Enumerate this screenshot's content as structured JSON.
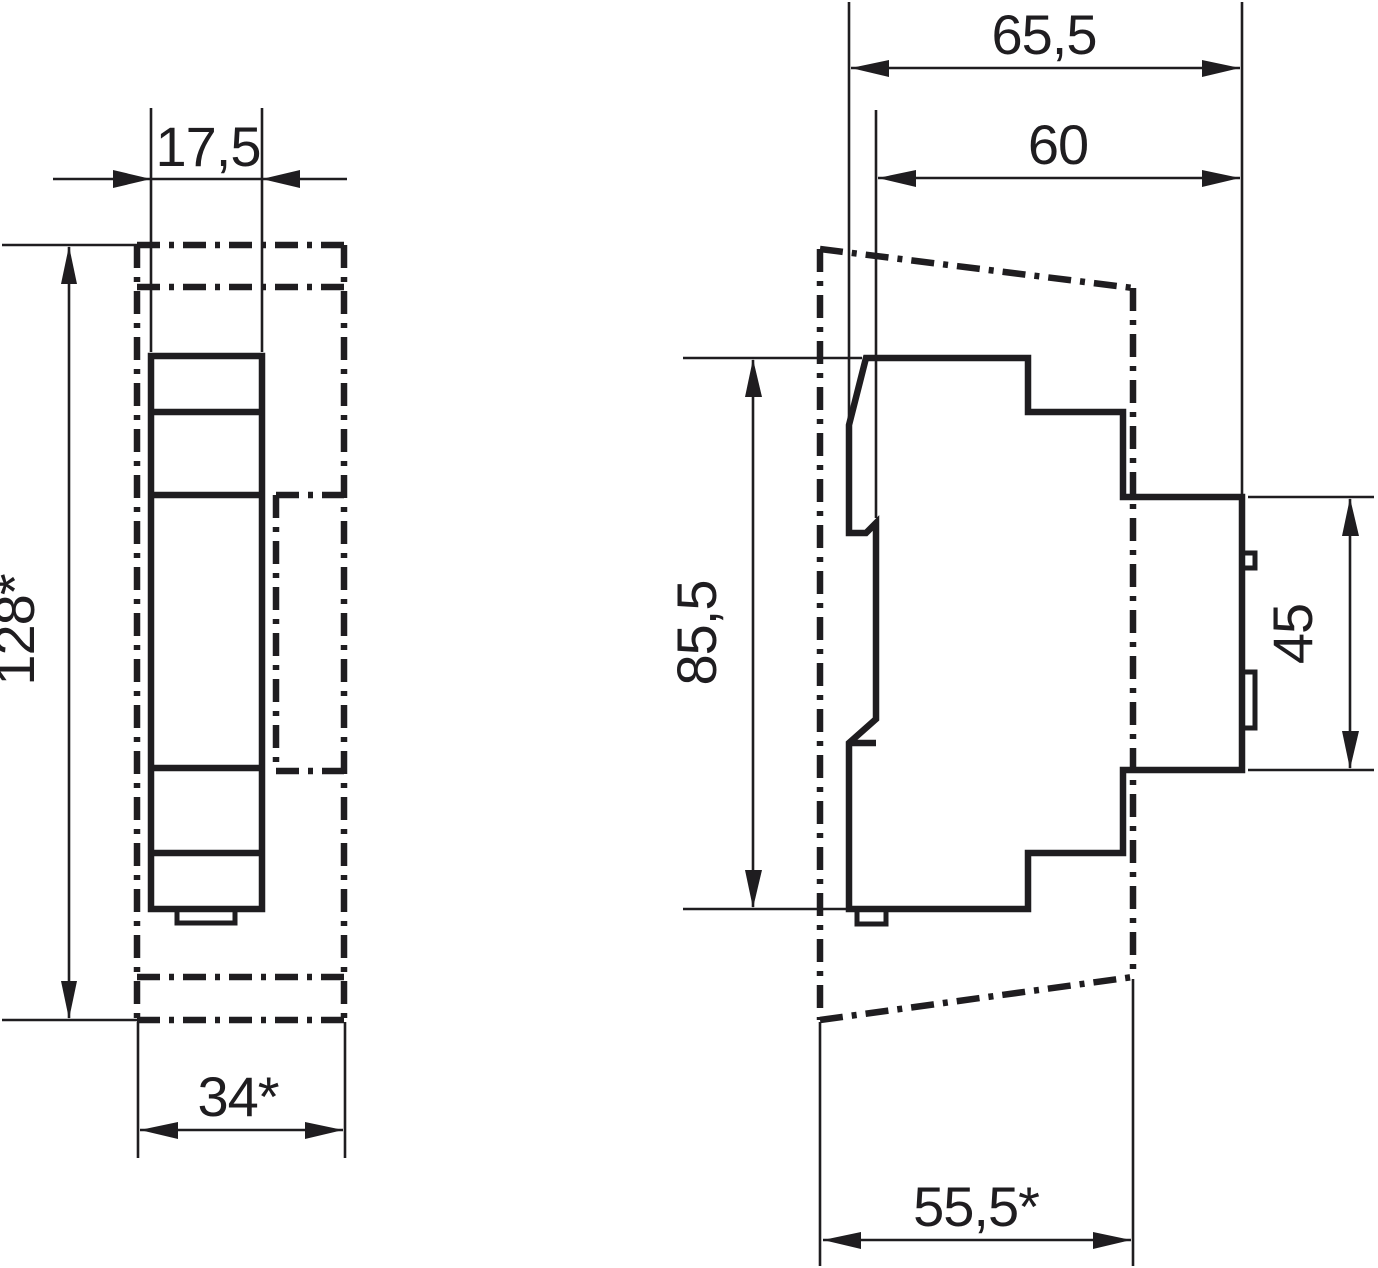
{
  "drawing": {
    "type": "dimension-drawing",
    "ink_color": "#1f1d20",
    "background_color": "#ffffff",
    "front_view": {
      "width_mm": "17,5",
      "height_mm": "128*",
      "cutout_width_mm": "34*"
    },
    "side_view": {
      "overall_depth_mm": "65,5",
      "body_depth_mm": "60",
      "body_height_mm": "85,5",
      "front_section_height_mm": "45",
      "cutout_depth_mm": "55,5*"
    }
  }
}
